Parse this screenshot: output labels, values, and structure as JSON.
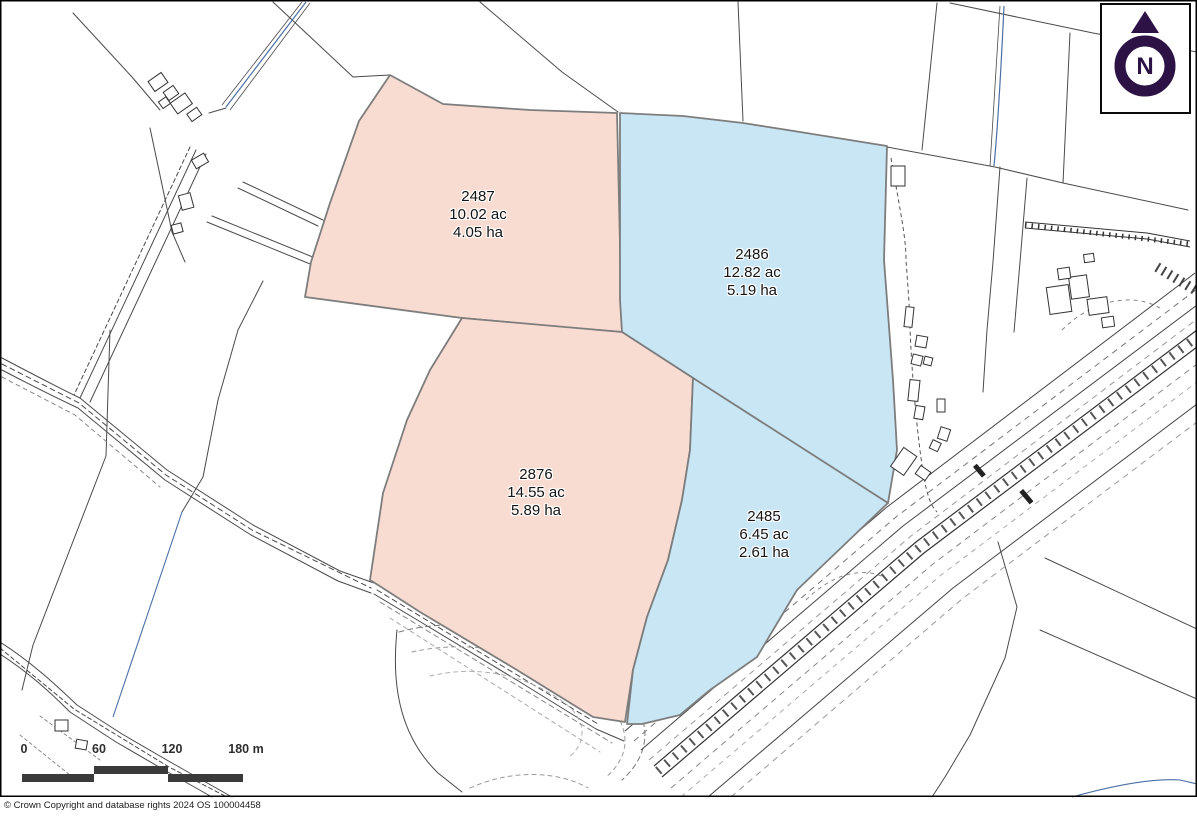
{
  "map": {
    "parcels": [
      {
        "id": "2487",
        "acres": "10.02 ac",
        "hectares": "4.05 ha",
        "fill": "#f8dcd1"
      },
      {
        "id": "2486",
        "acres": "12.82 ac",
        "hectares": "5.19 ha",
        "fill": "#c9e6f5"
      },
      {
        "id": "2876",
        "acres": "14.55 ac",
        "hectares": "5.89 ha",
        "fill": "#f8dcd1"
      },
      {
        "id": "2485",
        "acres": "6.45 ac",
        "hectares": "2.61 ha",
        "fill": "#c9e6f5"
      }
    ],
    "colors": {
      "parcel_pink": "#f8dcd1",
      "parcel_blue": "#c9e6f5",
      "parcel_outline": "#7d7d7d",
      "linework": "#4a4a4a",
      "water": "#4a6fa5",
      "north_symbol": "#2d1245",
      "scalebar": "#3a3a3a"
    }
  },
  "north": {
    "label": "N"
  },
  "scalebar": {
    "tick0": "0",
    "tick1": "60",
    "tick2": "120",
    "tick3": "180 m"
  },
  "footer": {
    "copyright": "© Crown Copyright and database rights 2024 OS 100004458"
  }
}
